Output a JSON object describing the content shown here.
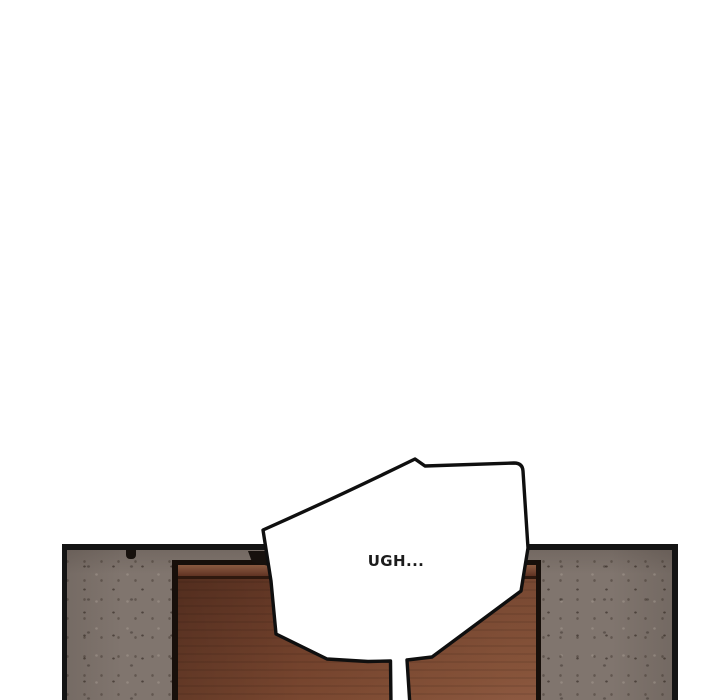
{
  "page": {
    "kind": "webtoon-comic-panel",
    "background": "#ffffff"
  },
  "panel": {
    "scene": "concrete wall with closed wooden door",
    "speech_bubble": {
      "text": "UGH..."
    }
  },
  "colors": {
    "page-bg": "#ffffff",
    "panel-border": "#141414",
    "wall-base": "#80756e",
    "door-frame": "#170f0a",
    "door-rail-light": "#8a5a40",
    "door-rail-dark": "#5f3322",
    "door-body-dark": "#5d3322",
    "door-body-light": "#84503a",
    "bubble-fill": "#ffffff",
    "bubble-stroke": "#0f0f0f",
    "text-color": "#1c1c1c",
    "wedge-color": "#17110d"
  }
}
